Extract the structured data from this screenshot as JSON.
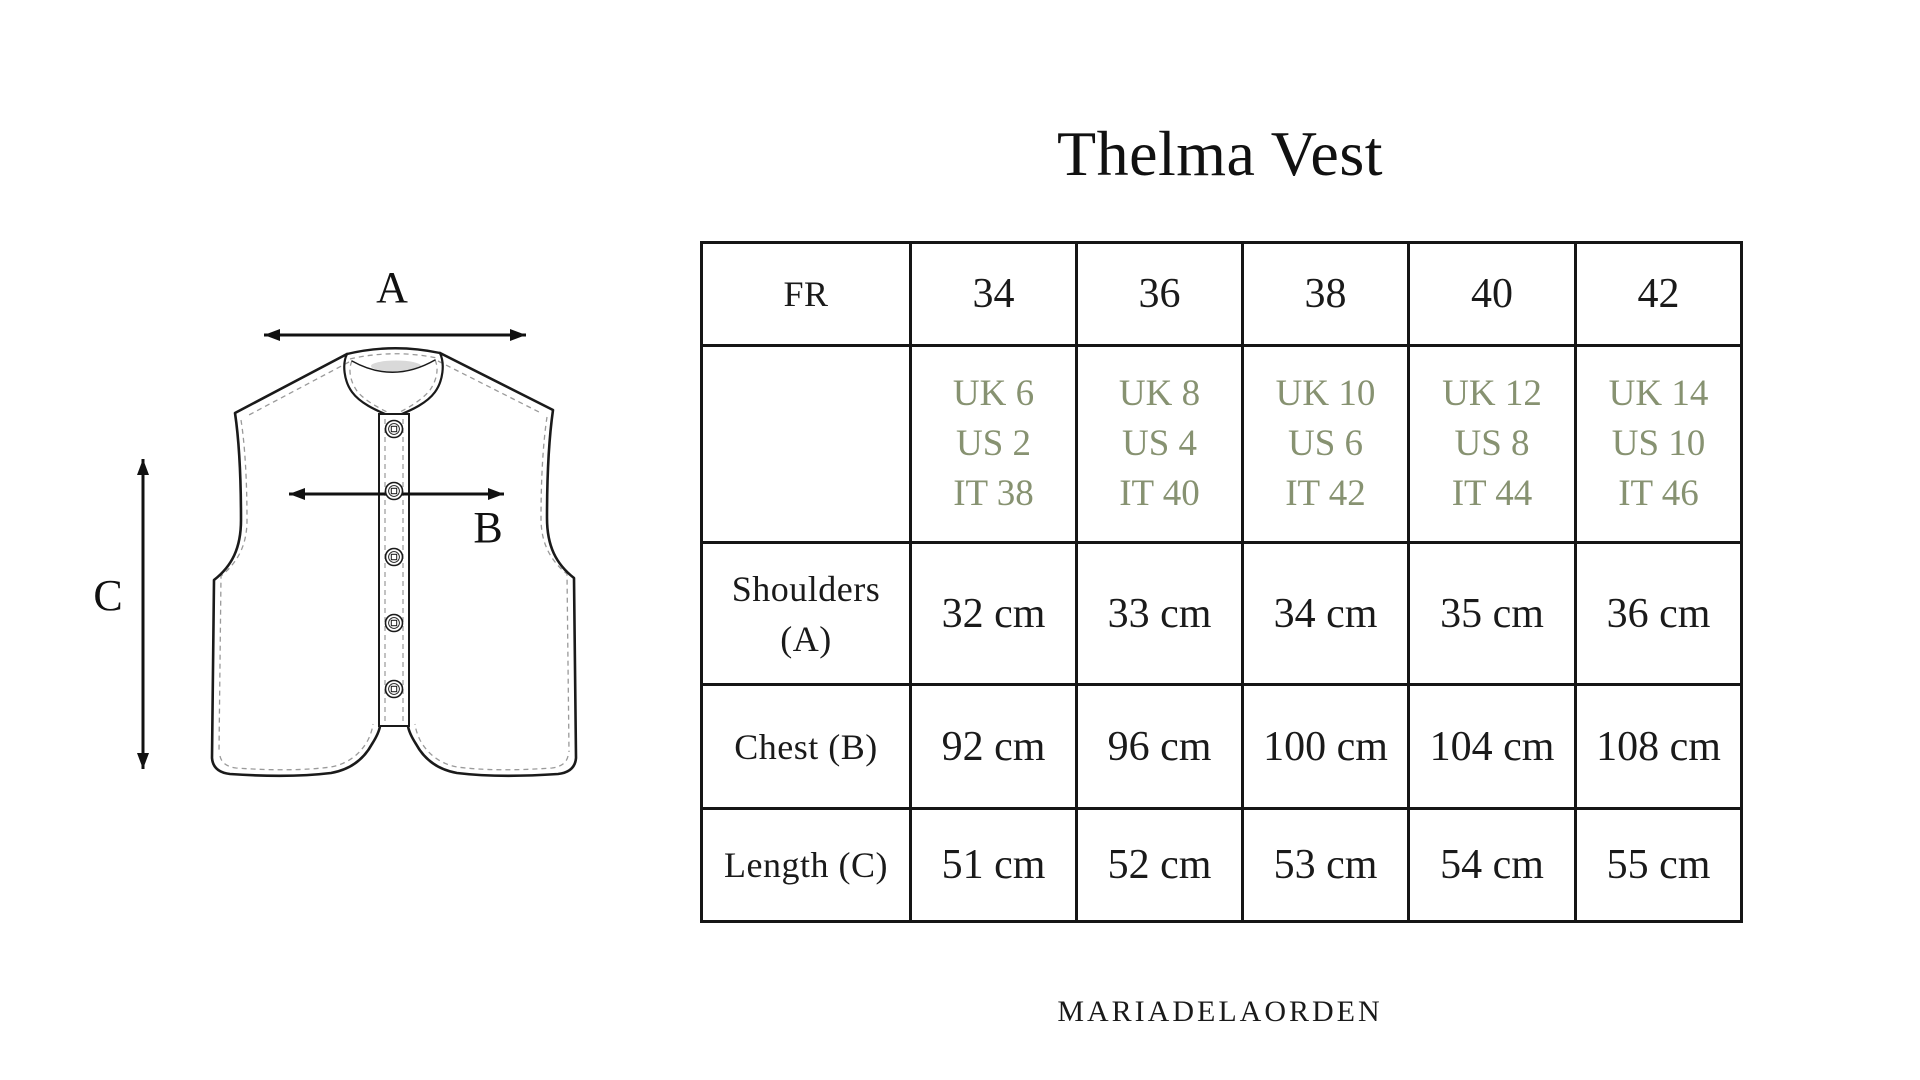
{
  "page": {
    "title": "Thelma Vest",
    "brand": "MARIADELAORDEN",
    "background_color": "#ffffff",
    "text_color": "#1a1a1a",
    "accent_green": "#879271"
  },
  "diagram": {
    "labels": {
      "a": "A",
      "b": "B",
      "c": "C"
    }
  },
  "size_table": {
    "header": {
      "label": "FR",
      "sizes": [
        "34",
        "36",
        "38",
        "40",
        "42"
      ]
    },
    "conversions": {
      "values": [
        [
          "UK 6",
          "US 2",
          "IT 38"
        ],
        [
          "UK 8",
          "US 4",
          "IT 40"
        ],
        [
          "UK 10",
          "US 6",
          "IT 42"
        ],
        [
          "UK 12",
          "US 8",
          "IT 44"
        ],
        [
          "UK 14",
          "US 10",
          "IT 46"
        ]
      ]
    },
    "rows": [
      {
        "label_lines": [
          "Shoulders",
          "(A)"
        ],
        "values": [
          "32 cm",
          "33 cm",
          "34 cm",
          "35 cm",
          "36 cm"
        ]
      },
      {
        "label_lines": [
          "Chest (B)"
        ],
        "values": [
          "92 cm",
          "96 cm",
          "100 cm",
          "104 cm",
          "108 cm"
        ]
      },
      {
        "label_lines": [
          "Length (C)"
        ],
        "values": [
          "51 cm",
          "52 cm",
          "53 cm",
          "54 cm",
          "55 cm"
        ]
      }
    ]
  }
}
